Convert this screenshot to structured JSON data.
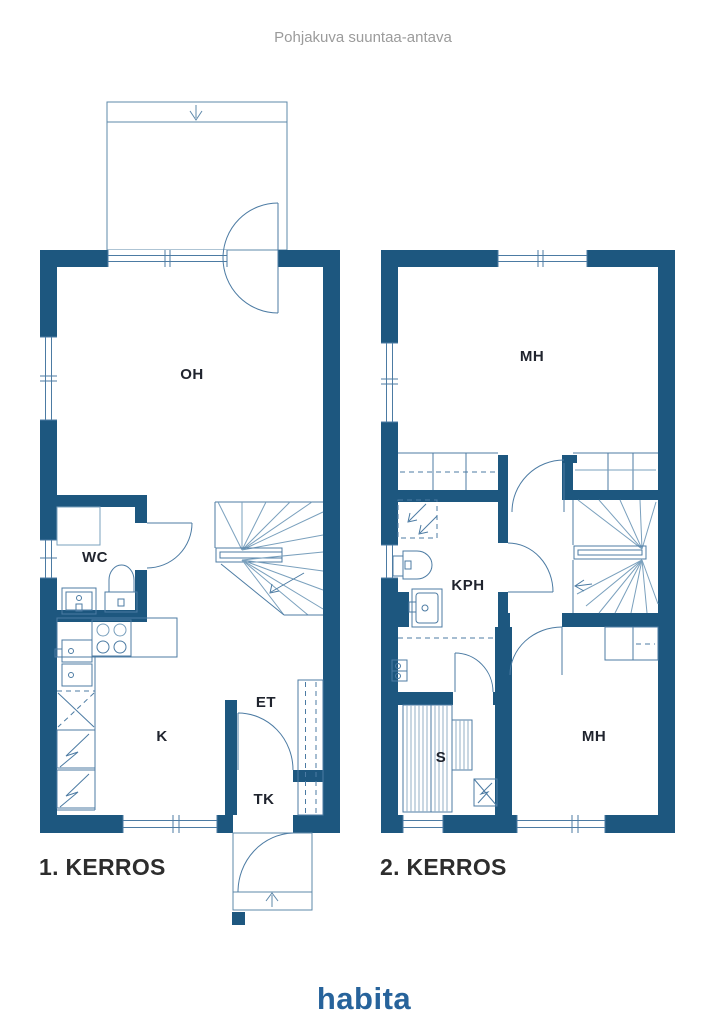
{
  "title": "Pohjakuva suuntaa-antava",
  "floor1": {
    "label": "1. KERROS",
    "rooms": {
      "oh": "OH",
      "wc": "WC",
      "k": "K",
      "et": "ET",
      "tk": "TK"
    }
  },
  "floor2": {
    "label": "2. KERROS",
    "rooms": {
      "mh_top": "MH",
      "kph": "KPH",
      "s": "S",
      "mh_bottom": "MH"
    }
  },
  "logo": {
    "text": "habita",
    "color": "#27639b"
  },
  "colors": {
    "wall": "#1d577f",
    "line": "#4c7ba3",
    "line_light": "#7aa0bd",
    "room_label": "#20242e",
    "floor_label": "#2d2d2d",
    "title": "#9b9b9b"
  }
}
